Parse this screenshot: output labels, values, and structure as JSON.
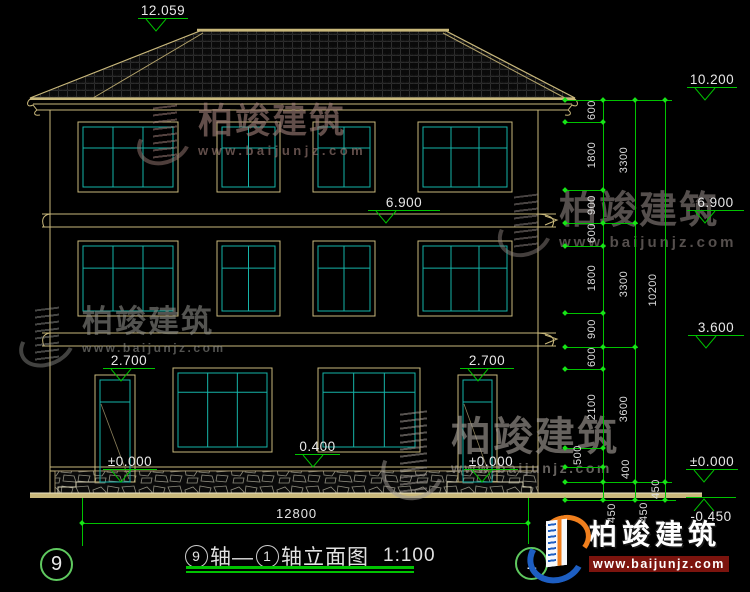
{
  "watermark": {
    "name": "柏竣建筑",
    "site": "www.baijunjz.com"
  },
  "logo": {
    "name": "柏竣建筑",
    "site": "www.baijunjz.com"
  },
  "title": {
    "axis_from": "9",
    "axis_join": "轴—",
    "axis_to": "1",
    "suffix": "轴立面图",
    "scale": "1:100"
  },
  "axis_bubbles": {
    "left": "9",
    "right": "1"
  },
  "overall_dim": {
    "label": "12800"
  },
  "colors": {
    "line_green": "#00c300",
    "cad_tan": "#c9b87b",
    "glass_teal": "#15b3a8",
    "text_white": "#e6e6e6",
    "logo_blue": "#1d5ec2",
    "logo_orange": "#f07f1d",
    "logo_red": "#7c140e"
  },
  "markers": {
    "apex": {
      "label": "12.059",
      "x": 138,
      "y": 31,
      "lw": 50
    },
    "mid": [
      {
        "label": "6.900",
        "x": 368,
        "y": 223,
        "lw": 72
      },
      {
        "label": "2.700",
        "x": 103,
        "y": 381,
        "lw": 52
      },
      {
        "label": "2.700",
        "x": 460,
        "y": 381,
        "lw": 54
      },
      {
        "label": "0.400",
        "x": 295,
        "y": 467,
        "lw": 45
      },
      {
        "label": "±0.000",
        "x": 103,
        "y": 482,
        "lw": 54
      },
      {
        "label": "±0.000",
        "x": 464,
        "y": 482,
        "lw": 54
      }
    ],
    "right": [
      {
        "label": "10.200",
        "x": 687,
        "y": 100,
        "lw": 50
      },
      {
        "label": "6.900",
        "x": 687,
        "y": 223,
        "lw": 57
      },
      {
        "label": "3.600",
        "x": 688,
        "y": 348,
        "lw": 56
      },
      {
        "label": "±0.000",
        "x": 686,
        "y": 482,
        "lw": 52
      },
      {
        "label": "-0.450",
        "x": 686,
        "y": 497,
        "lw": 50,
        "neg": true
      }
    ]
  },
  "dim_chain": [
    {
      "v": "600",
      "x": 592,
      "y": 111
    },
    {
      "v": "1800",
      "x": 592,
      "y": 156
    },
    {
      "v": "900",
      "x": 592,
      "y": 206
    },
    {
      "v": "600",
      "x": 592,
      "y": 234
    },
    {
      "v": "1800",
      "x": 592,
      "y": 279
    },
    {
      "v": "900",
      "x": 592,
      "y": 330
    },
    {
      "v": "600",
      "x": 592,
      "y": 358
    },
    {
      "v": "2100",
      "x": 592,
      "y": 408
    },
    {
      "v": "500",
      "x": 578,
      "y": 456
    },
    {
      "v": "400",
      "x": 626,
      "y": 470
    },
    {
      "v": "450",
      "x": 612,
      "y": 514
    },
    {
      "v": "3300",
      "x": 624,
      "y": 161
    },
    {
      "v": "3300",
      "x": 624,
      "y": 285
    },
    {
      "v": "3600",
      "x": 624,
      "y": 410
    },
    {
      "v": "450",
      "x": 644,
      "y": 513
    },
    {
      "v": "10200",
      "x": 653,
      "y": 291
    },
    {
      "v": "450",
      "x": 656,
      "y": 490
    }
  ]
}
